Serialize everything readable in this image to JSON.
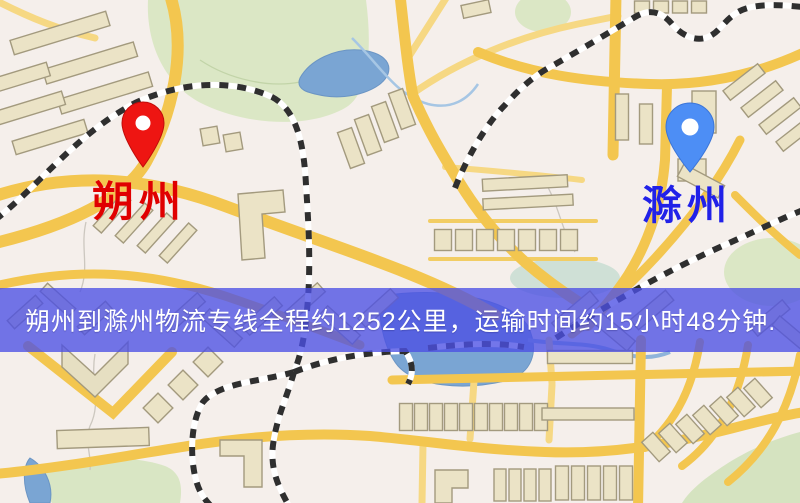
{
  "banner": {
    "text": "朔州到滁州物流专线全程约1252公里，运输时间约15小时48分钟.",
    "background_color": "#4c50e4",
    "text_color": "#ffffff"
  },
  "markers": {
    "origin": {
      "name": "朔州",
      "pin_color": "#ee1512",
      "label_color": "#e00000"
    },
    "destination": {
      "name": "滁州",
      "pin_color": "#4d8ef5",
      "label_color": "#2121e8"
    }
  },
  "map": {
    "palette": {
      "background": "#f5efeb",
      "park": "#dbe7c5",
      "water": "#7aa5d3",
      "road_major": "#f3c64f",
      "road_minor": "#f6d883",
      "building_fill": "#ebe3c6",
      "building_stroke": "#a39a7e",
      "railway": "#2f2f2f"
    }
  }
}
